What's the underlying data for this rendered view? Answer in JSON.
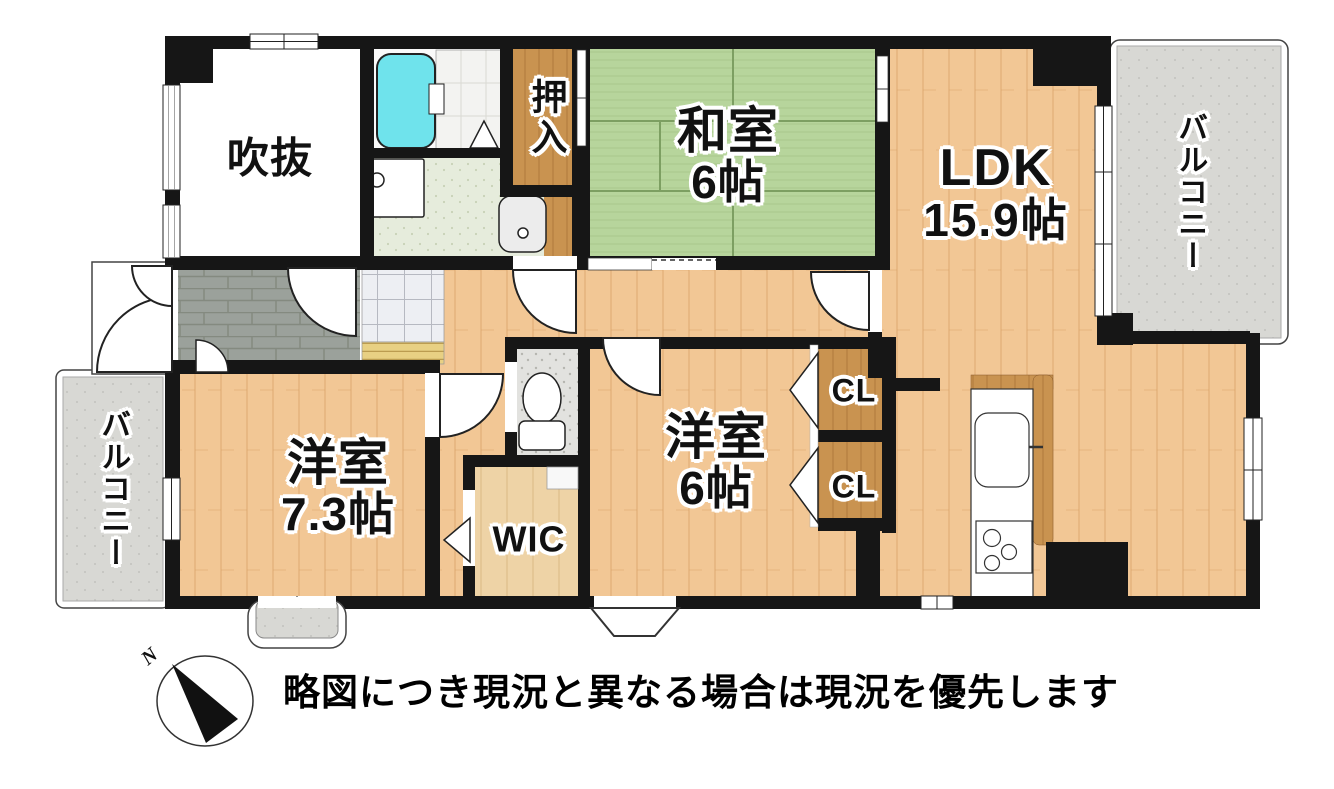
{
  "rooms": {
    "void": {
      "label": "吹抜"
    },
    "oshiire": {
      "label": "押入"
    },
    "washitsu": {
      "label": "和室",
      "size": "6帖"
    },
    "ldk": {
      "label": "LDK",
      "size": "15.9帖"
    },
    "balcony_right": {
      "label": "バルコニー"
    },
    "balcony_left": {
      "label": "バルコニー"
    },
    "western_73": {
      "label": "洋室",
      "size": "7.3帖"
    },
    "western_6": {
      "label": "洋室",
      "size": "6帖"
    },
    "closet1": {
      "label": "CL"
    },
    "closet2": {
      "label": "CL"
    },
    "wic": {
      "label": "WIC"
    }
  },
  "compass": {
    "north_label": "N"
  },
  "disclaimer": "略図につき現況と異なる場合は現況を優先します",
  "colors": {
    "wall": "#161616",
    "wood_floor": "#f2c795",
    "wood_dark": "#c99350",
    "tatami": "#b7d59c",
    "balcony": "#d8d8d4",
    "tub": "#6fe3ec",
    "genkan_tile": "#9ba19b",
    "toilet_floor": "#e2e2df",
    "washroom_floor": "#e6ecdc"
  }
}
